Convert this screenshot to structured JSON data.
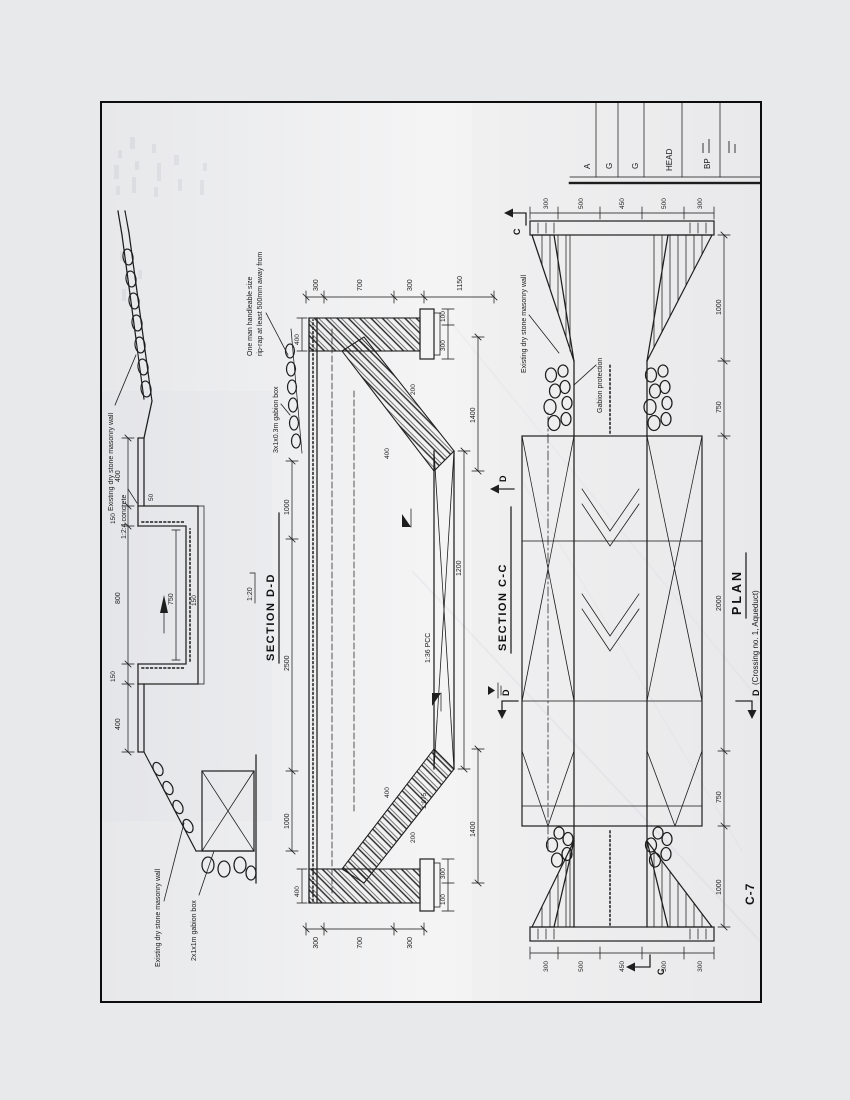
{
  "colors": {
    "page_bg": "#e8e9eb",
    "paper": "#f2f2f3",
    "ink": "#1e1e1e"
  },
  "drawing_number": "C-7",
  "section_dd": {
    "title": "SECTION D-D",
    "notes": {
      "concrete": "1:2:4 concrete",
      "masonry_wall_right": "Existing dry stone masonry wall",
      "masonry_wall_left": "Existing dry stone masonry wall",
      "gabion_box_left": "2x1x1m gabion box",
      "gabion_box_right": "3x1x0.3m gabion box",
      "riprap_1": "One man handleable size",
      "riprap_2": "rip-rap at least 500mm away from",
      "slope": "1:20"
    },
    "dims": {
      "top": [
        "400",
        "150",
        "800",
        "150",
        "400"
      ],
      "inner_width": "750",
      "floor": "150",
      "lip": "50",
      "bottom": [
        "1000",
        "2500",
        "1000"
      ]
    }
  },
  "section_cc": {
    "title": "SECTION C-C",
    "section_marker": "D",
    "notes": {
      "pcc": "1:36 PCC",
      "bed_slope": "1:975"
    },
    "dims": {
      "left_chain": [
        "300",
        "700",
        "300"
      ],
      "right_chain": [
        "300",
        "700",
        "300",
        "1150"
      ],
      "left_footing": [
        "100",
        "300"
      ],
      "right_footing": [
        "300",
        "100"
      ],
      "bed_length": "1200",
      "left_transition": "1400",
      "right_transition": "1400",
      "left_wall_top": "400",
      "right_wall_top": "400",
      "left_apron": "400",
      "right_apron": "400",
      "left_toe": "200",
      "right_toe": "200"
    }
  },
  "plan": {
    "title": "PLAN",
    "subtitle": "(Crossing no. 1, Aqueduct)",
    "section_marker_c": "C",
    "section_marker_d": "D",
    "notes": {
      "masonry_wall": "Existing dry stone masonry wall",
      "gabion": "Gabion protection"
    },
    "dims": {
      "left_end_chain": [
        "300",
        "500",
        "450",
        "500",
        "300"
      ],
      "right_end_chain": [
        "300",
        "500",
        "450",
        "500",
        "300"
      ],
      "bottom_chain": [
        "1000",
        "750",
        "2000",
        "750",
        "1000"
      ]
    }
  },
  "side_table": {
    "rows": [
      "A",
      "G",
      "G",
      "HEAD",
      "BP"
    ]
  }
}
